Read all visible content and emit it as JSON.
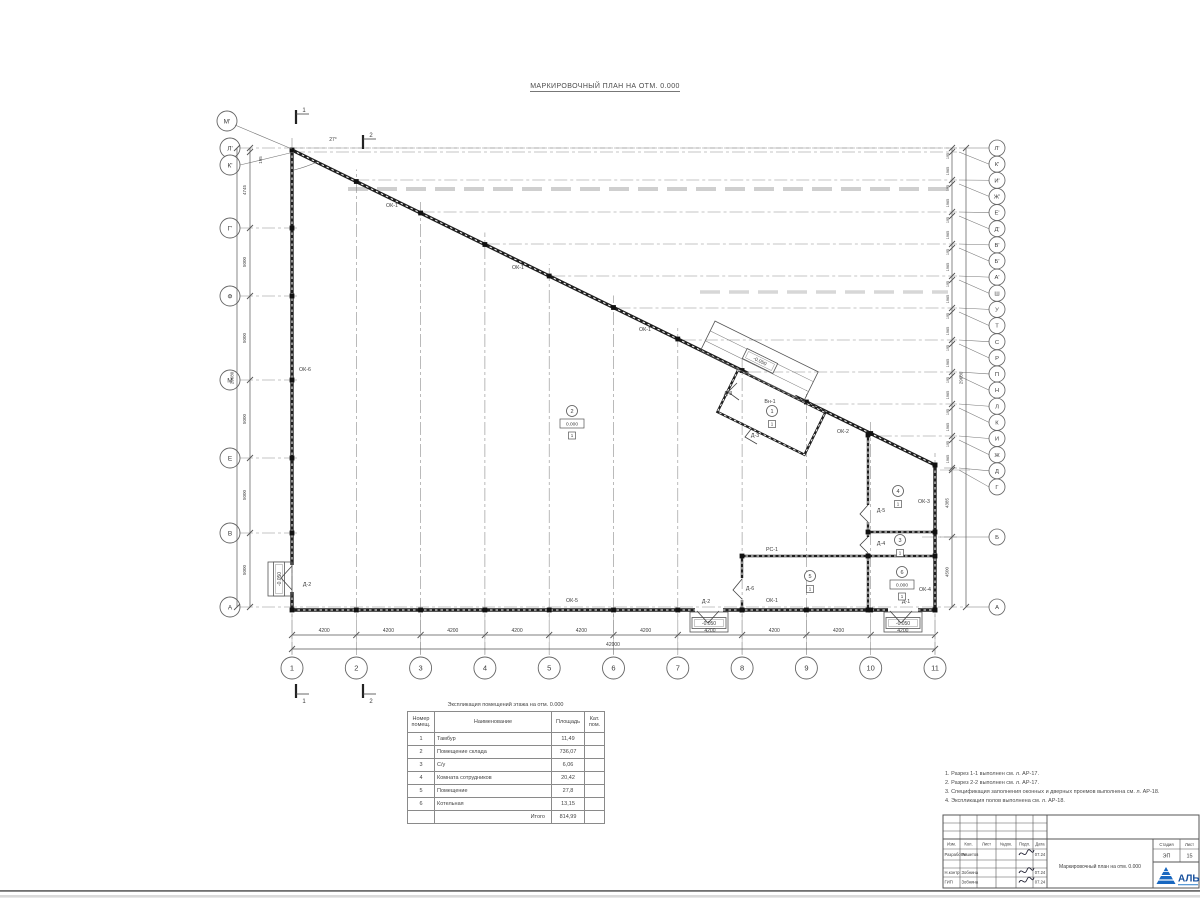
{
  "sheet": {
    "title": "МАРКИРОВОЧНЫЙ ПЛАН НА ОТМ. 0.000"
  },
  "plan": {
    "angle_label": "27°",
    "axes_bottom": {
      "labels": [
        "1",
        "2",
        "3",
        "4",
        "5",
        "6",
        "7",
        "8",
        "9",
        "10",
        "11"
      ],
      "dim_each": "4200",
      "total": "42000"
    },
    "axes_left": {
      "labels": [
        "М'",
        "Л'",
        "К'",
        "Г'",
        "Ф",
        "М",
        "Е",
        "В",
        "А"
      ],
      "dims": [
        "195",
        "4745",
        "5000",
        "5000",
        "5000",
        "5000",
        "5000"
      ],
      "total": "29680"
    },
    "axes_right": {
      "labels": [
        "Л'",
        "К'",
        "И'",
        "Ж'",
        "Е'",
        "Д'",
        "В'",
        "Б'",
        "А'",
        "Ш",
        "У",
        "Т",
        "С",
        "Р",
        "П",
        "Н",
        "Л",
        "К",
        "И",
        "Ж",
        "Д",
        "Г",
        "Б",
        "А"
      ],
      "pair_dims": [
        "195",
        "1965"
      ],
      "end_dims": [
        "4385",
        "4500"
      ],
      "total": "29680"
    },
    "section_marks": [
      "1",
      "2"
    ],
    "element_labels": [
      {
        "text": "ОК-1",
        "x": 392,
        "y": 207
      },
      {
        "text": "ОК-1",
        "x": 518,
        "y": 269
      },
      {
        "text": "ОК-1",
        "x": 645,
        "y": 331
      },
      {
        "text": "ОК-2",
        "x": 843,
        "y": 433
      },
      {
        "text": "ОК-3",
        "x": 924,
        "y": 503
      },
      {
        "text": "ОК-4",
        "x": 925,
        "y": 591
      },
      {
        "text": "ОК-5",
        "x": 572,
        "y": 602
      },
      {
        "text": "ОК-6",
        "x": 305,
        "y": 371
      },
      {
        "text": "ОК-1",
        "x": 772,
        "y": 602
      },
      {
        "text": "Д-1",
        "x": 906,
        "y": 603
      },
      {
        "text": "Д-2",
        "x": 706,
        "y": 603
      },
      {
        "text": "Д-2",
        "x": 307,
        "y": 586
      },
      {
        "text": "Д-3",
        "x": 728,
        "y": 395
      },
      {
        "text": "Д-3",
        "x": 755,
        "y": 437
      },
      {
        "text": "Д-4",
        "x": 881,
        "y": 545
      },
      {
        "text": "Д-5",
        "x": 881,
        "y": 512
      },
      {
        "text": "Д-6",
        "x": 750,
        "y": 590
      },
      {
        "text": "Вн-1",
        "x": 770,
        "y": 403
      },
      {
        "text": "РС-1",
        "x": 772,
        "y": 551
      }
    ],
    "room_tags": [
      {
        "num": "1",
        "x": 772,
        "y": 411,
        "level": ""
      },
      {
        "num": "2",
        "x": 572,
        "y": 411,
        "level": "0.000"
      },
      {
        "num": "3",
        "x": 900,
        "y": 540,
        "level": ""
      },
      {
        "num": "4",
        "x": 898,
        "y": 491,
        "level": ""
      },
      {
        "num": "5",
        "x": 810,
        "y": 576,
        "level": ""
      },
      {
        "num": "6",
        "x": 902,
        "y": 572,
        "level": "0.000"
      }
    ],
    "floor_mark": "1",
    "level_marks": [
      {
        "text": "-0.050",
        "x": 709,
        "y": 623,
        "rot": 0
      },
      {
        "text": "-0.050",
        "x": 903,
        "y": 623,
        "rot": 0
      },
      {
        "text": "-0.050",
        "x": 279,
        "y": 579,
        "rot": -90
      },
      {
        "text": "-0.050",
        "x": 760,
        "y": 361,
        "rot": 26.2
      }
    ]
  },
  "room_table": {
    "title": "Экспликация помещений этажа на отм. 0.000",
    "headers": [
      "Номер помещ.",
      "Наименование",
      "Площадь",
      "Кат. пом."
    ],
    "rows": [
      [
        "1",
        "Тамбур",
        "11,49"
      ],
      [
        "2",
        "Помещение склада",
        "736,07"
      ],
      [
        "3",
        "С/у",
        "6,06"
      ],
      [
        "4",
        "Комната сотрудников",
        "20,42"
      ],
      [
        "5",
        "Помещение",
        "27,8"
      ],
      [
        "6",
        "Котельная",
        "13,15"
      ]
    ],
    "total_label": "Итого",
    "total_value": "814,99"
  },
  "notes": [
    "1. Разрез 1-1 выполнен см. л. АР-17.",
    "2. Разрез 2-2 выполнен см. л. АР-17.",
    "3. Спецификация заполнения оконных и дверных проемов выполнена см. л. АР-18.",
    "4. Экспликация полов выполнена см. л. АР-18."
  ],
  "title_block": {
    "header_cols": [
      "Изм.",
      "Кол.",
      "Лист",
      "№док.",
      "Подп.",
      "Дата"
    ],
    "rows": [
      {
        "role": "Разработал",
        "name": "Решетов",
        "date": "07.24"
      },
      {
        "role": "Н.контр",
        "name": "Зобнина",
        "date": "07.24"
      },
      {
        "role": "ГИП",
        "name": "Зобнина",
        "date": "07.24"
      }
    ],
    "stage_label": "Стадия",
    "sheet_label": "Лист",
    "stage": "ЭП",
    "sheet": "15",
    "doc_title": "Маркировочный план на отм. 0.000",
    "logo_text": "АЛЬ",
    "logo_color": "#1867c0"
  }
}
